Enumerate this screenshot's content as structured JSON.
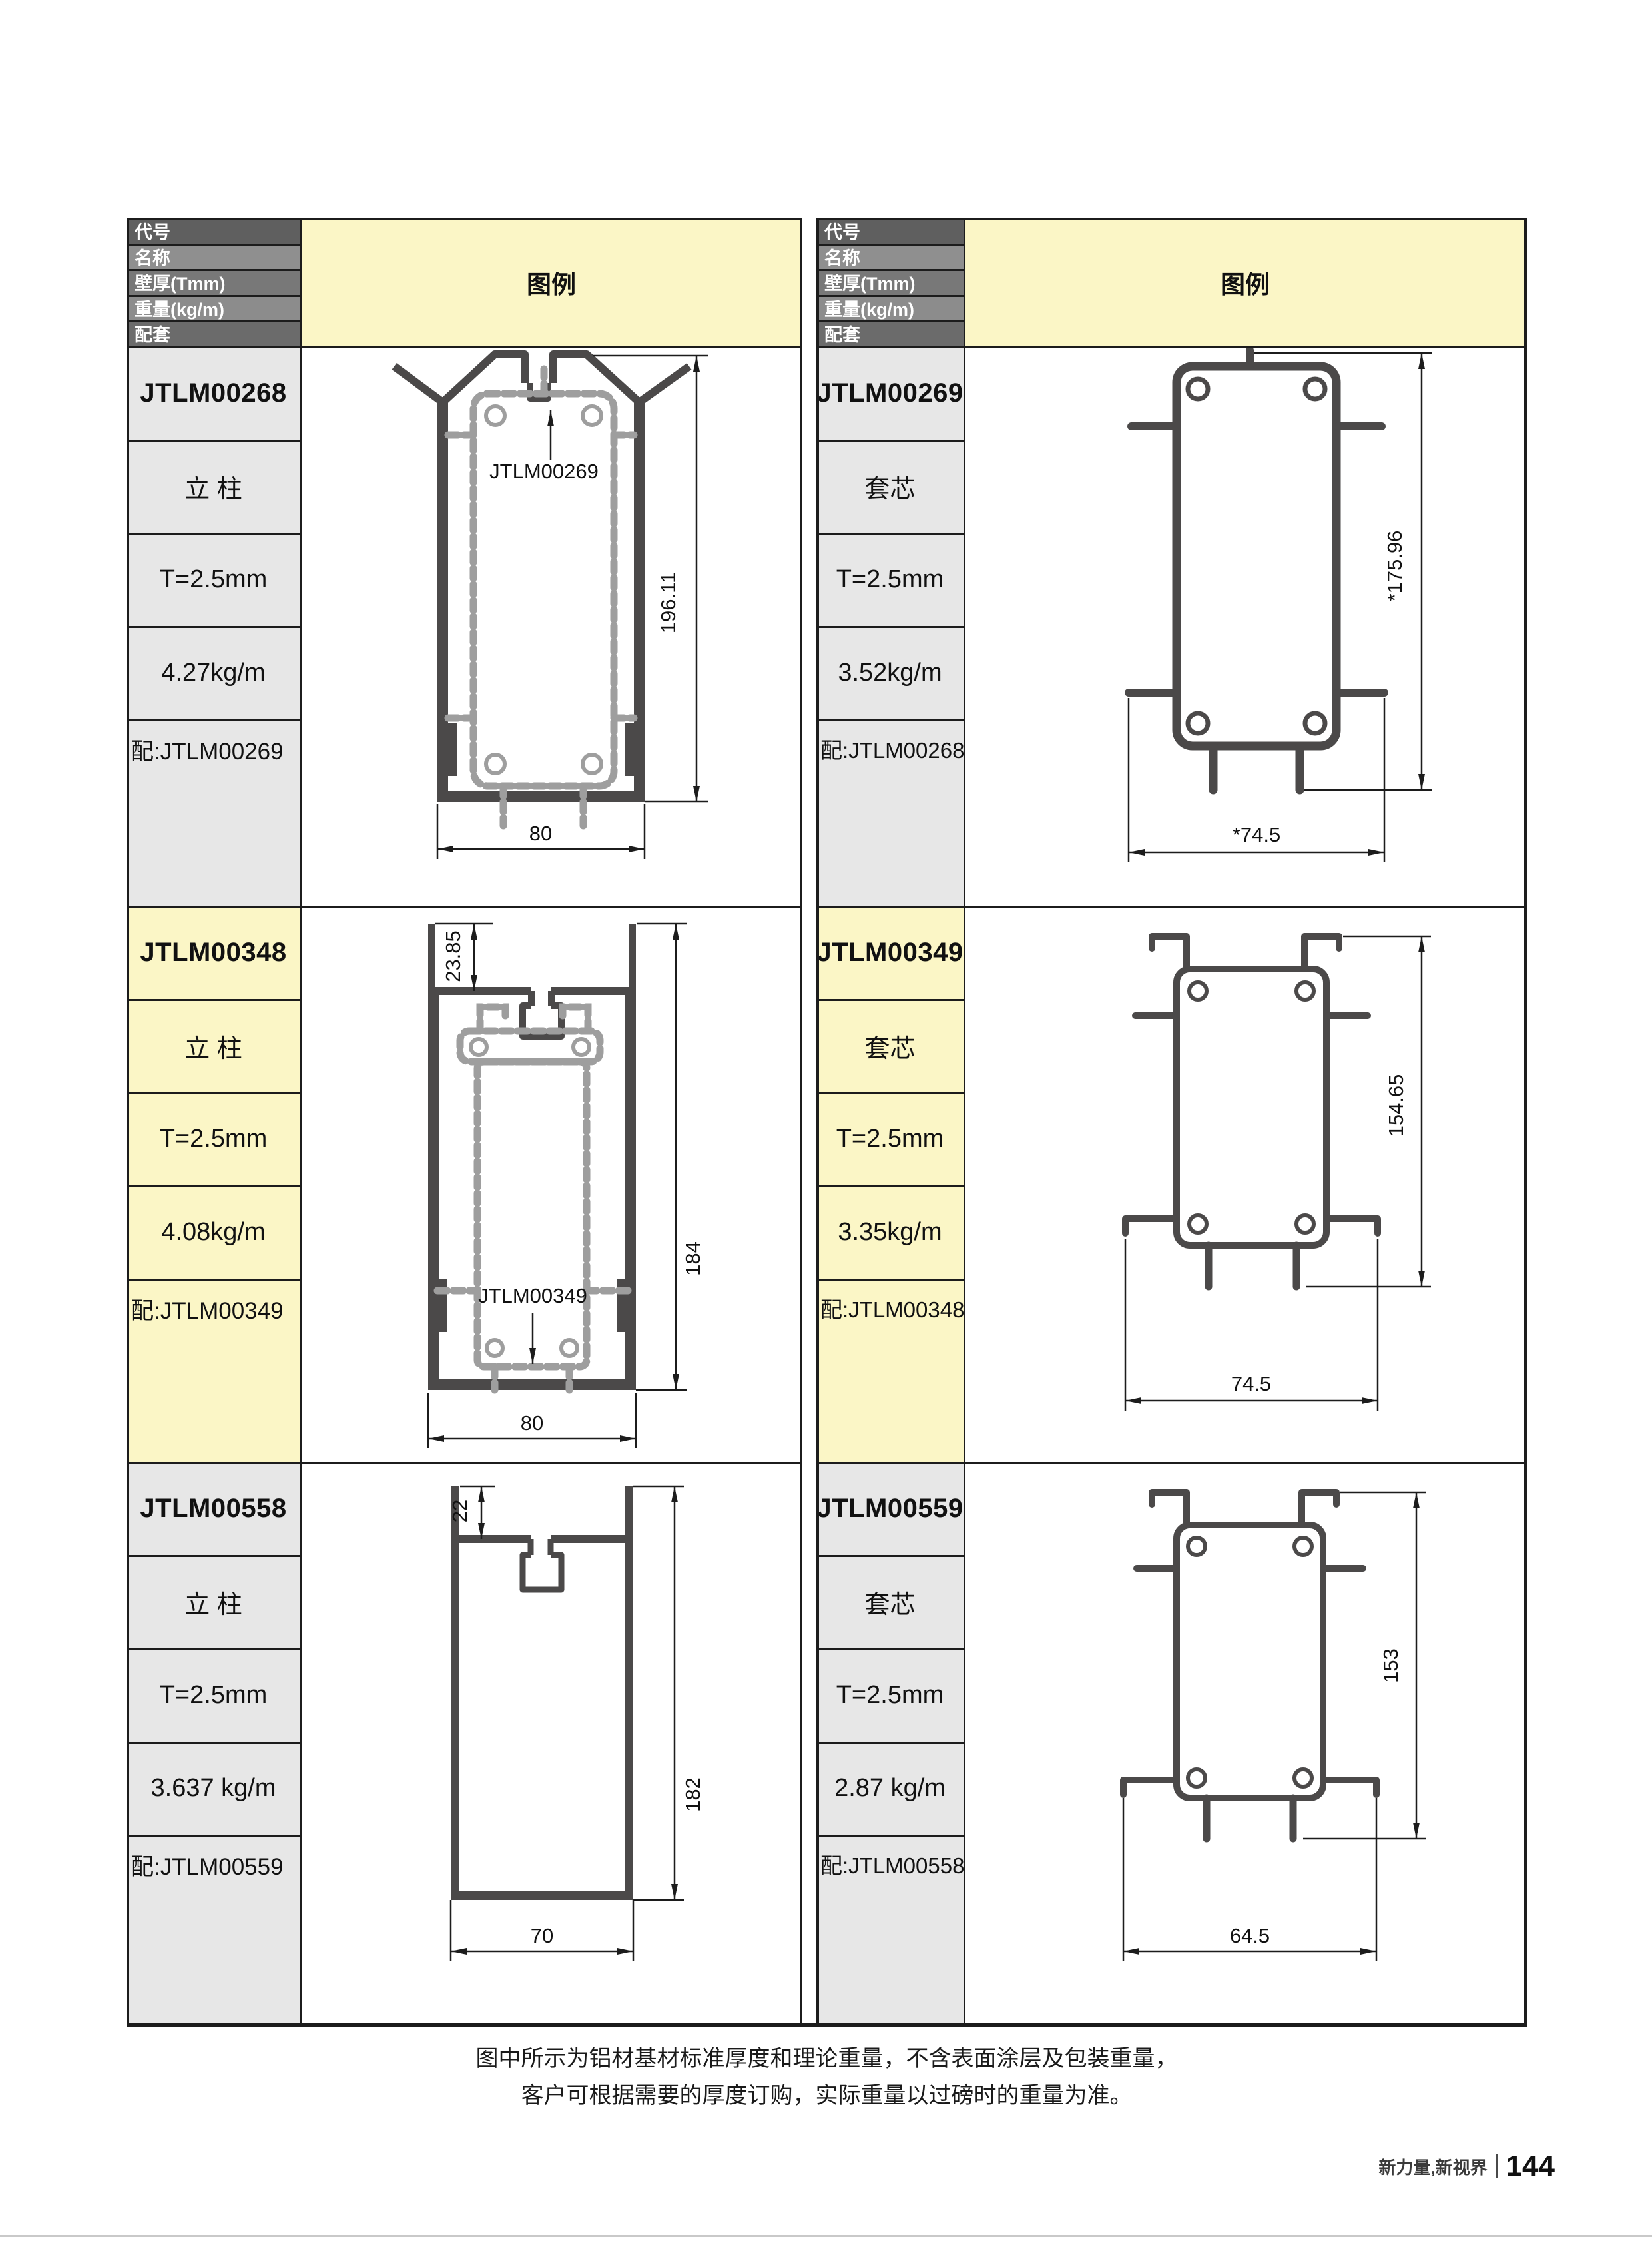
{
  "header_labels": {
    "code": "代号",
    "name": "名称",
    "thickness": "壁厚(Tmm)",
    "weight": "重量(kg/m)",
    "match": "配套",
    "legend": "图例"
  },
  "entries": [
    {
      "code": "JTLM00268",
      "name": "立 柱",
      "thickness": "T=2.5mm",
      "weight": "4.27kg/m",
      "match": "配:JTLM00269",
      "diagram": {
        "height": "196.11",
        "width": "80",
        "core_label": "JTLM00269"
      }
    },
    {
      "code": "JTLM00269",
      "name": "套芯",
      "thickness": "T=2.5mm",
      "weight": "3.52kg/m",
      "match": "配:JTLM00268",
      "diagram": {
        "height": "*175.96",
        "width": "*74.5"
      }
    },
    {
      "code": "JTLM00348",
      "name": "立 柱",
      "thickness": "T=2.5mm",
      "weight": "4.08kg/m",
      "match": "配:JTLM00349",
      "diagram": {
        "height": "184",
        "width": "80",
        "top": "23.85",
        "core_label": "JTLM00349"
      }
    },
    {
      "code": "JTLM00349",
      "name": "套芯",
      "thickness": "T=2.5mm",
      "weight": "3.35kg/m",
      "match": "配:JTLM00348",
      "diagram": {
        "height": "154.65",
        "width": "74.5"
      }
    },
    {
      "code": "JTLM00558",
      "name": "立 柱",
      "thickness": "T=2.5mm",
      "weight": "3.637 kg/m",
      "match": "配:JTLM00559",
      "diagram": {
        "height": "182",
        "width": "70",
        "top": "22"
      }
    },
    {
      "code": "JTLM00559",
      "name": "套芯",
      "thickness": "T=2.5mm",
      "weight": "2.87 kg/m",
      "match": "配:JTLM00558",
      "diagram": {
        "height": "153",
        "width": "64.5"
      }
    }
  ],
  "note": {
    "line1": "图中所示为铝材基材标准厚度和理论重量，不含表面涂层及包装重量，",
    "line2": "客户可根据需要的厚度订购，实际重量以过磅时的重量为准。"
  },
  "footer": {
    "slogan": "新力量,新视界",
    "page_number": "144"
  },
  "colors": {
    "accent_yellow": "#FBF6C6",
    "cell_gray": "#E7E7E7",
    "header_dark": "#5F5F5F",
    "header_light": "#8F8F8F",
    "border": "#1C1C1C",
    "profile_dark": "#4B4949",
    "core_gray": "#9E9E9E",
    "footer_line": "#C9C9C9"
  }
}
